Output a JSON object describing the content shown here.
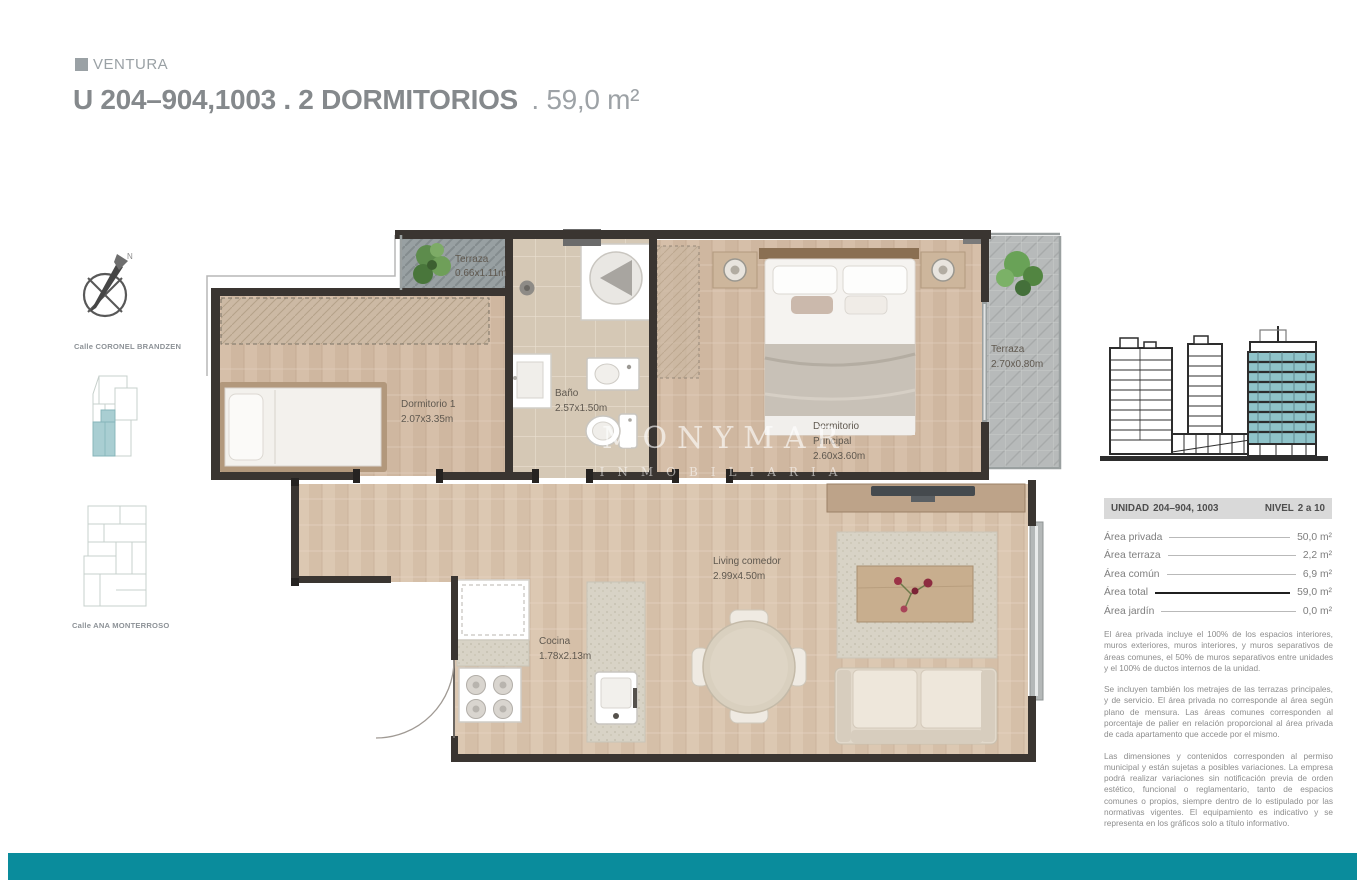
{
  "brand": {
    "name": "VENTURA"
  },
  "title": {
    "main": "U 204–904,1003 . 2 DORMITORIOS",
    "area_suffix": ". 59,0 m²"
  },
  "sidebar": {
    "compass_n": "N",
    "street_top": "Calle CORONEL BRANDZEN",
    "street_bottom": "Calle ANA MONTERROSO"
  },
  "plan": {
    "watermark": {
      "line1": "MONYMAR",
      "line2": "INMOBILIARIA"
    },
    "labels": {
      "terraza_top": {
        "name": "Terraza",
        "dims": "0.66x1.11m"
      },
      "dorm1": {
        "name": "Dormitorio 1",
        "dims": "2.07x3.35m"
      },
      "bano": {
        "name": "Baño",
        "dims": "2.57x1.50m"
      },
      "dorm_ppal": {
        "name1": "Dormitorio",
        "name2": "Principal",
        "dims": "2.60x3.60m"
      },
      "terraza_right": {
        "name": "Terraza",
        "dims": "2.70x0.80m"
      },
      "living": {
        "name": "Living comedor",
        "dims": "2.99x4.50m"
      },
      "cocina": {
        "name": "Cocina",
        "dims": "1.78x2.13m"
      }
    }
  },
  "unit_table": {
    "unidad_label": "UNIDAD",
    "unidad_value": "204–904, 1003",
    "nivel_label": "NIVEL",
    "nivel_value": "2 a 10",
    "rows": [
      {
        "label": "Área privada",
        "value": "50,0 m²"
      },
      {
        "label": "Área terraza",
        "value": "2,2 m²"
      },
      {
        "label": "Área común",
        "value": "6,9 m²"
      },
      {
        "label": "Área total",
        "value": "59,0 m²"
      },
      {
        "label": "Área jardín",
        "value": "0,0 m²"
      }
    ]
  },
  "legal": {
    "p1": "El área privada incluye el 100% de los espacios interiores, muros exteriores, muros interiores, y muros separativos de áreas comunes, el 50% de muros separativos entre unidades y el 100% de ductos internos de la unidad.",
    "p2": "Se incluyen también los metrajes de las terrazas principales, y de servicio. El área privada no corresponde al área según plano de mensura. Las áreas comunes corresponden al porcentaje de palier en relación proporcional al área privada de cada apartamento que accede por el mismo.",
    "p3": "Las dimensiones y contenidos corresponden al permiso municipal y están sujetas a posibles variaciones. La empresa podrá realizar variaciones sin notificación previa de orden estético, funcional o reglamentario, tanto de espacios comunes o propios, siempre dentro de lo estipulado por las normativas vigentes. El equipamiento es indicativo y se representa en los gráficos solo a título informativo."
  },
  "colors": {
    "accent_teal": "#0a8c9c",
    "building_highlight": "#8fc3c9",
    "site_highlight": "#a9ced2",
    "table_header_gray": "#d9d9d9"
  }
}
